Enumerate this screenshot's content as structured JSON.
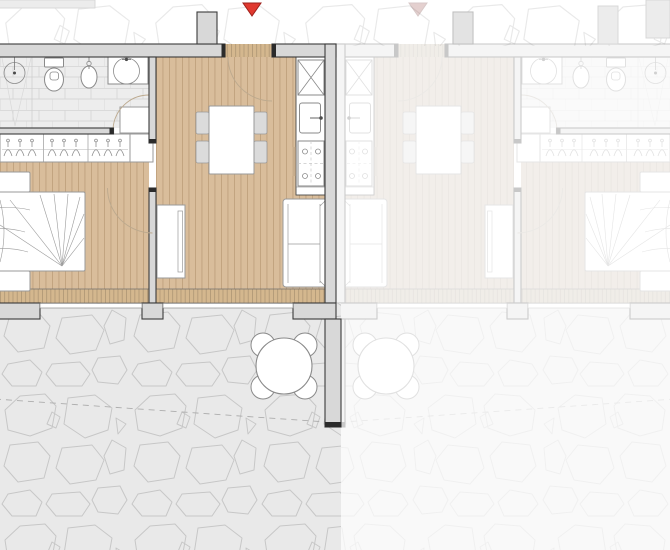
{
  "colors": {
    "wood": "#D9BD9B",
    "wood_line": "rgba(121,85,47,.28)",
    "deck": "#D4B78E",
    "deck_line": "rgba(0,0,0,.18)",
    "wall_fill": "#D8D8D8",
    "wall_stroke": "#3B3B3B",
    "cap": "#2B2B2B",
    "tile_bg": "#EDEDED",
    "tile_line": "#D7D7D7",
    "terrace_bg": "#E9E9E9",
    "stone_line": "#C7C7C7",
    "outside_stone_line": "#E3E3E3",
    "fixture": "#8A8A8A",
    "furniture": "#9A9A9A",
    "chair_fill": "#DBDBDB",
    "marker": "#E0392F",
    "marker_stroke": "#9E201B",
    "arc": "#BCA98E",
    "dash": "#ADADAD",
    "kitchen_stroke": "#4A4A4A",
    "oven_handle": "#C8AD8C"
  },
  "plan": {
    "marker": {
      "icon": "entrance-marker-triangle",
      "color_ref": "marker"
    },
    "units": [
      {
        "id": "unit-a",
        "state": "active-highlighted",
        "floor_finish": "wood"
      },
      {
        "id": "unit-b",
        "state": "inactive-faded-mirrored",
        "floor_finish": "wood"
      }
    ],
    "rooms": [
      "bathroom",
      "wardrobe-hall",
      "bedroom",
      "living-dining",
      "kitchen",
      "terrace"
    ],
    "fixtures": {
      "bathroom": [
        "shower",
        "toilet",
        "bidet",
        "washbasin"
      ],
      "kitchen": [
        "tall-cabinet",
        "sink",
        "cooktop"
      ],
      "bedroom": [
        "double-bed",
        "nightstand",
        "nightstand",
        "wardrobe-hangers"
      ],
      "living_dining": [
        "dining-table",
        "dining-chairs-4",
        "sofa",
        "tv-sideboard"
      ],
      "terrace": [
        "round-table",
        "outdoor-chairs-4",
        "stone-paving",
        "boundary-dashed-line"
      ]
    }
  }
}
